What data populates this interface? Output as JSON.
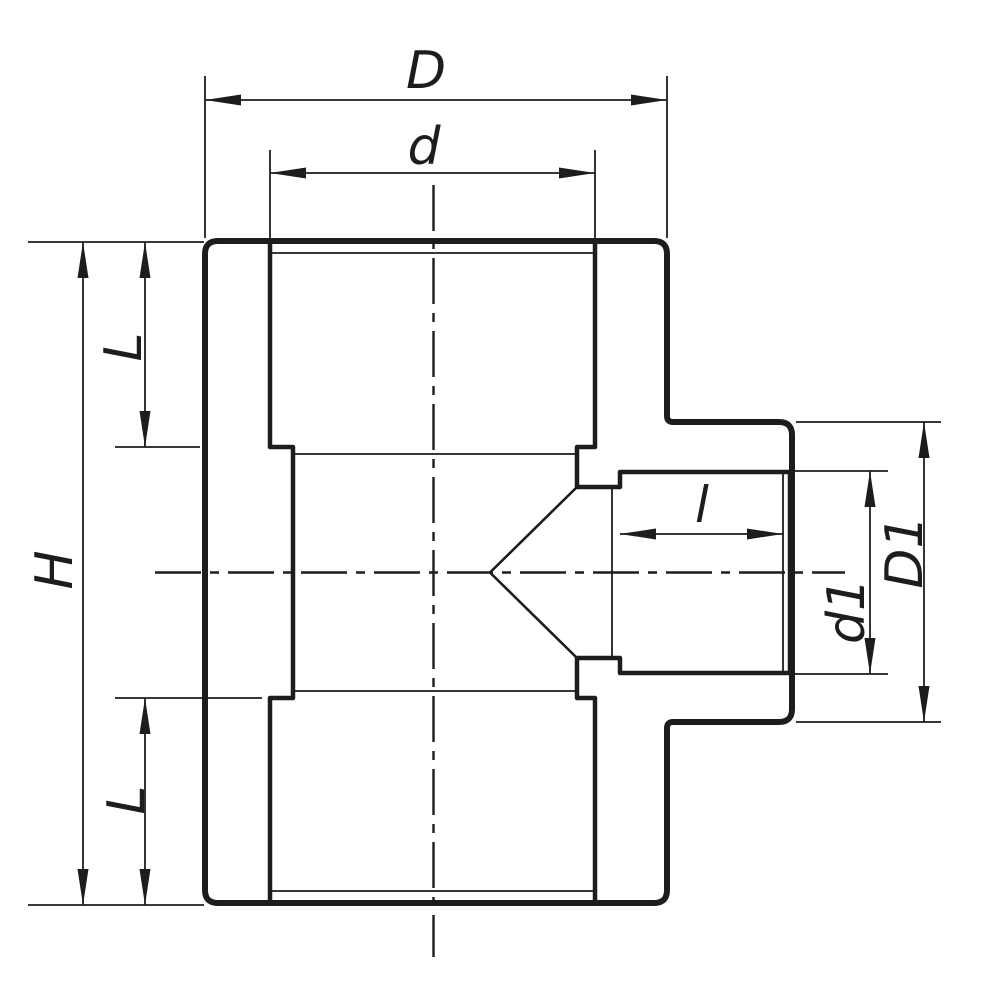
{
  "drawing": {
    "labels": {
      "overall_width": "D",
      "socket_bore": "d",
      "overall_height": "H",
      "socket_depth_top": "L",
      "socket_depth_bottom": "L",
      "branch_socket_depth": "l",
      "branch_bore": "d1",
      "branch_outer_diameter": "D1"
    },
    "colors": {
      "ink": "#1d1d1d",
      "paper": "#ffffff"
    }
  }
}
